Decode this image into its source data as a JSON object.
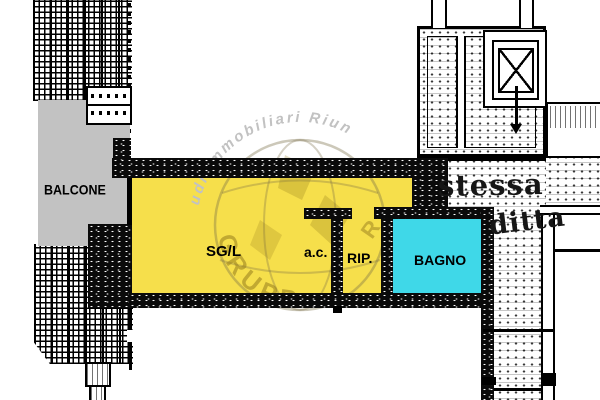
{
  "plan": {
    "rooms": {
      "balcone": {
        "label": "BALCONE",
        "color": "#C2C2C2"
      },
      "sgl": {
        "label": "SG/L",
        "color": "#F6DF4B"
      },
      "ac": {
        "label": "a.c."
      },
      "rip": {
        "label": "RIP."
      },
      "bagno": {
        "label": "BAGNO",
        "color": "#3FD8E8"
      }
    },
    "neighbor_note": {
      "line1": "stessa",
      "line2": "ditta"
    },
    "watermark": {
      "arc_text": "udi Immobiliari Riun",
      "brand_text": "GRUPPO",
      "side_letter": "R",
      "gray": "#C2C2C2",
      "olive": "#9C861B"
    },
    "colors": {
      "wall": "#000000",
      "paper": "#FFFFFF"
    }
  }
}
